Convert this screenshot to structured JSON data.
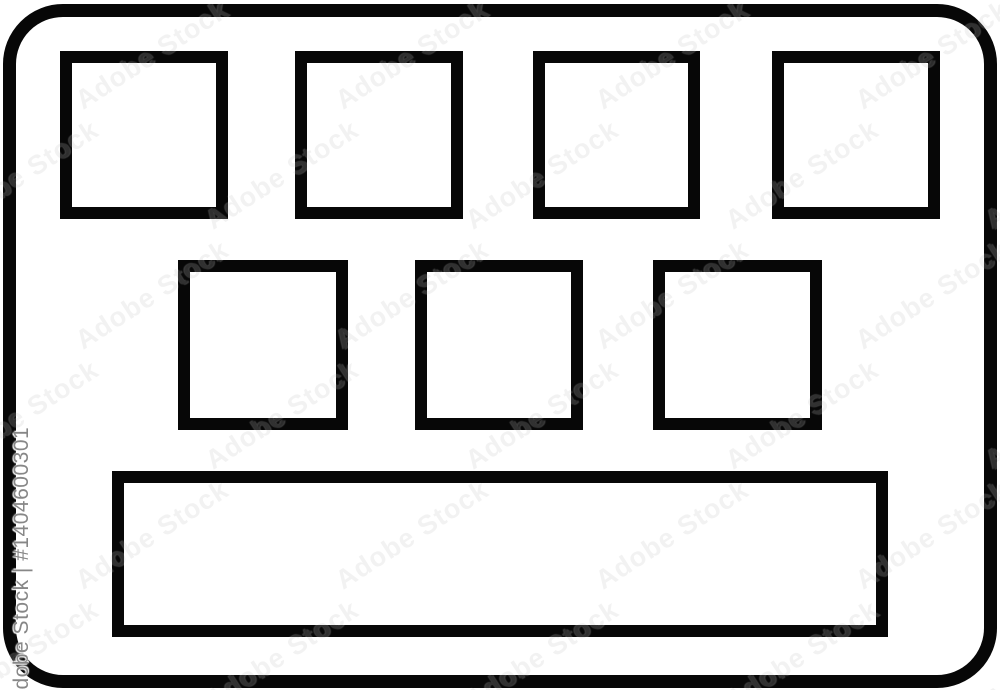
{
  "watermark": {
    "tile_text": "Adobe Stock",
    "credit_text": "Adobe Stock | #1404600301",
    "tile_color": "#969696",
    "credit_color": "#878787"
  },
  "icon": {
    "type": "keyboard",
    "stroke_color": "#070707",
    "background_color": "#ffffff",
    "top_row_key_count": 4,
    "middle_row_key_count": 3,
    "spacebar_count": 1
  }
}
